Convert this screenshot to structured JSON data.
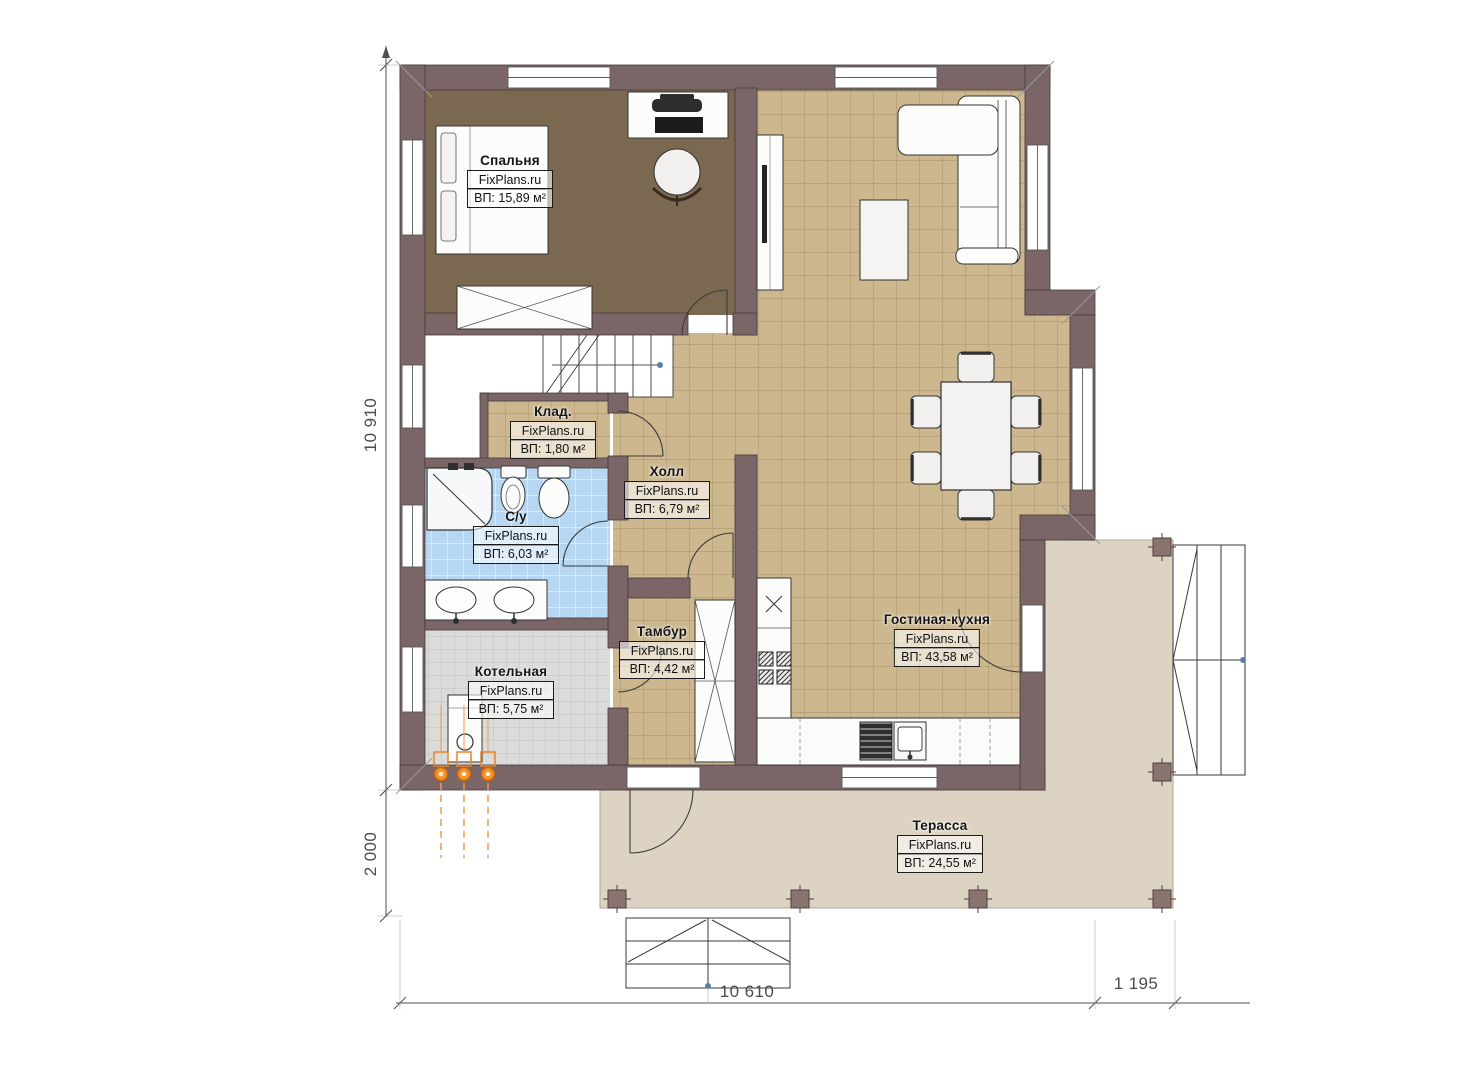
{
  "plan": {
    "rooms": {
      "bedroom": {
        "name": "Спальня",
        "watermark": "FixPlans.ru",
        "area": "ВП: 15,89 м²"
      },
      "storage": {
        "name": "Клад.",
        "watermark": "FixPlans.ru",
        "area": "ВП: 1,80 м²"
      },
      "bathroom": {
        "name": "С/у",
        "watermark": "FixPlans.ru",
        "area": "ВП: 6,03 м²"
      },
      "hall": {
        "name": "Холл",
        "watermark": "FixPlans.ru",
        "area": "ВП: 6,79 м²"
      },
      "vestibule": {
        "name": "Тамбур",
        "watermark": "FixPlans.ru",
        "area": "ВП: 4,42 м²"
      },
      "boiler_room": {
        "name": "Котельная",
        "watermark": "FixPlans.ru",
        "area": "ВП: 5,75 м²"
      },
      "living_kitchen": {
        "name": "Гостиная-кухня",
        "watermark": "FixPlans.ru",
        "area": "ВП: 43,58 м²"
      },
      "terrace": {
        "name": "Терасса",
        "watermark": "FixPlans.ru",
        "area": "ВП: 24,55 м²"
      }
    },
    "dimensions": {
      "left_total": "10 910",
      "left_terrace": "2 000",
      "bottom_main": "10 610",
      "bottom_terrace": "1 195"
    },
    "colors": {
      "wall": "#7a6567",
      "bedroom_floor": "#7b6850",
      "tile_floor": "#ccb78e",
      "bathroom_floor": "#b6d6f1",
      "boiler_floor": "#dbdbd9",
      "terrace_floor": "#ddd3c2",
      "heating_accent": "#f0841c"
    }
  }
}
